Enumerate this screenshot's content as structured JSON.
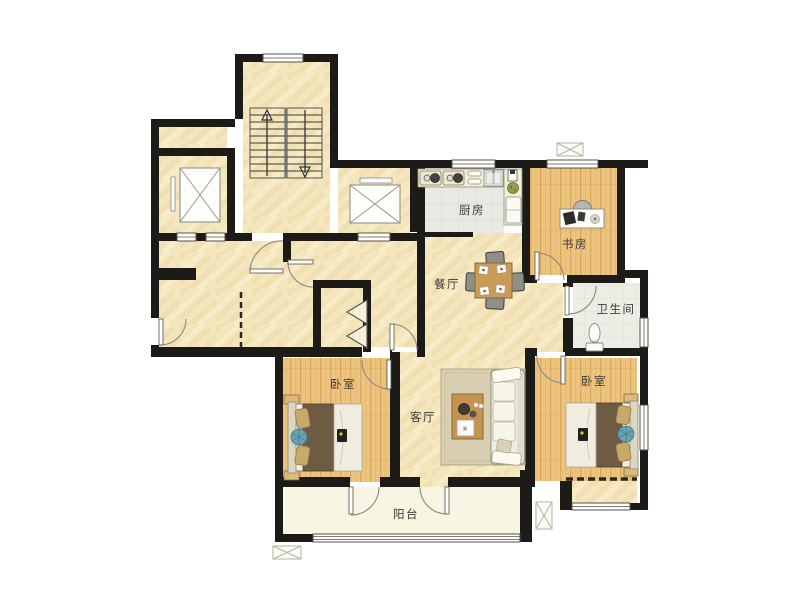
{
  "rooms": {
    "kitchen": {
      "label": "厨房"
    },
    "study": {
      "label": "书房"
    },
    "dining": {
      "label": "餐厅"
    },
    "bathroom": {
      "label": "卫生间"
    },
    "bedroom_left": {
      "label": "卧室"
    },
    "living_room": {
      "label": "客厅"
    },
    "bedroom_right": {
      "label": "卧室"
    },
    "balcony": {
      "label": "阳台"
    }
  },
  "colors": {
    "wall": "#1d1b18",
    "floor_cream": "#f4e6bd",
    "floor_wood": "#ecc47e",
    "floor_kitchen_tile": "#e9e9e3",
    "floor_bath_tile": "#eeede5",
    "floor_balcony": "#f8f5e2",
    "bed_blanket": "#6e5b44",
    "furniture_wood": "#c69450",
    "accent_blue": "#6aa3b0"
  }
}
